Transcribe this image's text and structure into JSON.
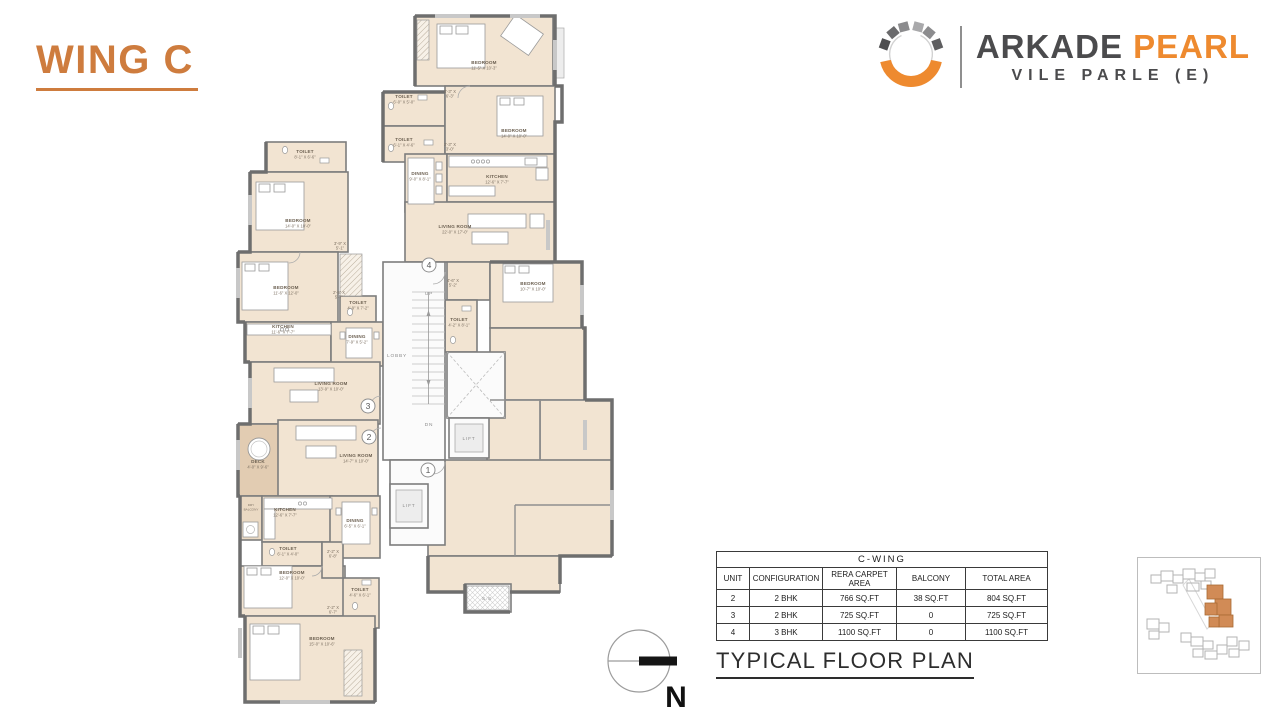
{
  "title": {
    "wing": "WING C"
  },
  "brand": {
    "primary": "ARKADE",
    "accent": "PEARL",
    "location": "VILE PARLE (E)"
  },
  "caption": "TYPICAL FLOOR PLAN",
  "compass": {
    "label": "N"
  },
  "colors": {
    "title_orange": "#CE7C3E",
    "logo_orange": "#EE8A2F",
    "dark_gray": "#4B4B4D",
    "room_fill": "#F2E4D2",
    "deck_fill": "#E2CCB2",
    "wall_gray": "#6E6E6E"
  },
  "table": {
    "title": "C-WING",
    "headers": [
      "UNIT",
      "CONFIGURATION",
      "RERA  CARPET AREA",
      "BALCONY",
      "TOTAL AREA"
    ],
    "rows": [
      [
        "2",
        "2 BHK",
        "766 SQ.FT",
        "38 SQ.FT",
        "804 SQ.FT"
      ],
      [
        "3",
        "2 BHK",
        "725 SQ.FT",
        "0",
        "725 SQ.FT"
      ],
      [
        "4",
        "3 BHK",
        "1100 SQ.FT",
        "0",
        "1100 SQ.FT"
      ]
    ]
  },
  "plan": {
    "rooms": [
      [
        415,
        16,
        138,
        70,
        "r"
      ],
      [
        383,
        92,
        62,
        34,
        "r"
      ],
      [
        383,
        126,
        62,
        36,
        "r"
      ],
      [
        445,
        86,
        110,
        68,
        "r"
      ],
      [
        405,
        154,
        42,
        58,
        "r"
      ],
      [
        447,
        154,
        108,
        48,
        "r"
      ],
      [
        405,
        202,
        150,
        60,
        "r"
      ],
      [
        447,
        262,
        43,
        38,
        "r"
      ],
      [
        490,
        262,
        92,
        66,
        "r"
      ],
      [
        445,
        300,
        32,
        52,
        "r"
      ],
      [
        266,
        142,
        80,
        30,
        "r"
      ],
      [
        250,
        172,
        98,
        80,
        "r"
      ],
      [
        238,
        252,
        100,
        70,
        "r"
      ],
      [
        340,
        296,
        36,
        26,
        "r"
      ],
      [
        245,
        322,
        86,
        40,
        "r"
      ],
      [
        331,
        322,
        52,
        44,
        "r"
      ],
      [
        250,
        362,
        130,
        62,
        "r"
      ],
      [
        238,
        424,
        42,
        72,
        "d"
      ],
      [
        278,
        420,
        100,
        76,
        "r"
      ],
      [
        240,
        496,
        22,
        44,
        "b"
      ],
      [
        262,
        496,
        70,
        46,
        "r"
      ],
      [
        330,
        496,
        50,
        62,
        "r"
      ],
      [
        262,
        542,
        60,
        24,
        "r"
      ],
      [
        240,
        566,
        105,
        50,
        "r"
      ],
      [
        343,
        578,
        36,
        50,
        "r"
      ],
      [
        245,
        616,
        130,
        86,
        "r"
      ],
      [
        322,
        542,
        21,
        36,
        "r"
      ],
      [
        490,
        328,
        95,
        72,
        "r"
      ],
      [
        540,
        400,
        72,
        62,
        "r"
      ],
      [
        487,
        400,
        53,
        62,
        "r"
      ],
      [
        428,
        460,
        184,
        96,
        "r"
      ],
      [
        428,
        556,
        132,
        36,
        "r"
      ],
      [
        383,
        262,
        62,
        198,
        "w"
      ],
      [
        390,
        460,
        55,
        85,
        "w"
      ],
      [
        447,
        352,
        58,
        66,
        "w"
      ],
      [
        449,
        418,
        40,
        40,
        "w"
      ],
      [
        390,
        484,
        38,
        44,
        "w"
      ],
      [
        465,
        584,
        46,
        28,
        "w"
      ]
    ],
    "labels": [
      [
        484,
        64,
        "BEDROOM",
        "11'-5\" X 10'-3\"",
        "r"
      ],
      [
        450,
        93,
        "3'-3\" X",
        "6'-3\"",
        "d"
      ],
      [
        404,
        98,
        "TOILET",
        "6'-0\" X 5'-0\"",
        "r"
      ],
      [
        404,
        141,
        "TOILET",
        "6'-1\" X 4'-6\"",
        "r"
      ],
      [
        450,
        146,
        "2'-3\" X",
        "3'-0\"",
        "d"
      ],
      [
        514,
        132,
        "BEDROOM",
        "14'-0\" X 10'-0\"",
        "r"
      ],
      [
        420,
        175,
        "DINING",
        "9'-0\" X 8'-1\"",
        "r"
      ],
      [
        497,
        178,
        "KITCHEN",
        "12'-6\" X 7'-7\"",
        "r"
      ],
      [
        455,
        228,
        "LIVING ROOM",
        "22'-0\" X 17'-0\"",
        "r"
      ],
      [
        453,
        282,
        "4'-6\" X",
        "5'-2\"",
        "d"
      ],
      [
        533,
        285,
        "BEDROOM",
        "10'-7\" X 10'-0\"",
        "r"
      ],
      [
        459,
        321,
        "TOILET",
        "4'-2\" X 8'-1\"",
        "r"
      ],
      [
        305,
        153,
        "TOILET",
        "8'-1\" X 6'-6\"",
        "r"
      ],
      [
        298,
        222,
        "BEDROOM",
        "14'-0\" X 10'-0\"",
        "r"
      ],
      [
        340,
        245,
        "3'-9\" X",
        "5'-1\"",
        "d"
      ],
      [
        286,
        289,
        "BEDROOM",
        "11'-6\" X 12'-0\"",
        "r"
      ],
      [
        339,
        294,
        "2'-5\" X",
        "5'-7\"",
        "d"
      ],
      [
        358,
        304,
        "TOILET",
        "4'-9\" X 7'-2\"",
        "r"
      ],
      [
        283,
        328,
        "KITCHEN",
        "11'-6\" X 7'-7\"",
        "r"
      ],
      [
        357,
        338,
        "DINING",
        "7'-9\" X 5'-2\"",
        "r"
      ],
      [
        331,
        385,
        "LIVING ROOM",
        "13'-9\" X 10'-0\"",
        "r"
      ],
      [
        397,
        357,
        "LOBBY",
        "",
        "c"
      ],
      [
        429,
        295,
        "UP",
        "",
        "c"
      ],
      [
        429,
        426,
        "DN",
        "",
        "c"
      ],
      [
        258,
        463,
        "DECK",
        "4'-0\" X 9'-6\"",
        "r"
      ],
      [
        356,
        457,
        "LIVING ROOM",
        "14'-7\" X 10'-0\"",
        "r"
      ],
      [
        251,
        506,
        "DRY",
        "BALCONY",
        "t"
      ],
      [
        285,
        511,
        "KITCHEN",
        "12'-6\" X 7'-7\"",
        "r"
      ],
      [
        355,
        522,
        "DINING",
        "6'-5\" X 6'-1\"",
        "r"
      ],
      [
        288,
        550,
        "TOILET",
        "6'-1\" X 4'-0\"",
        "r"
      ],
      [
        333,
        553,
        "2'-2\" X",
        "6'-8\"",
        "d"
      ],
      [
        292,
        574,
        "BEDROOM",
        "12'-0\" X 10'-0\"",
        "r"
      ],
      [
        360,
        591,
        "TOILET",
        "4'-6\" X 6'-1\"",
        "r"
      ],
      [
        333,
        609,
        "2'-2\" X",
        "6'-7\"",
        "d"
      ],
      [
        322,
        640,
        "BEDROOM",
        "15'-0\" X 10'-6\"",
        "r"
      ],
      [
        469,
        440,
        "LIFT",
        "",
        "c"
      ],
      [
        409,
        507,
        "LIFT",
        "",
        "c"
      ],
      [
        487,
        600,
        "S.S",
        "",
        "c"
      ]
    ],
    "markers": [
      {
        "n": "1",
        "x": 428,
        "y": 470
      },
      {
        "n": "2",
        "x": 369,
        "y": 437
      },
      {
        "n": "3",
        "x": 368,
        "y": 406
      },
      {
        "n": "4",
        "x": 429,
        "y": 265
      }
    ]
  }
}
